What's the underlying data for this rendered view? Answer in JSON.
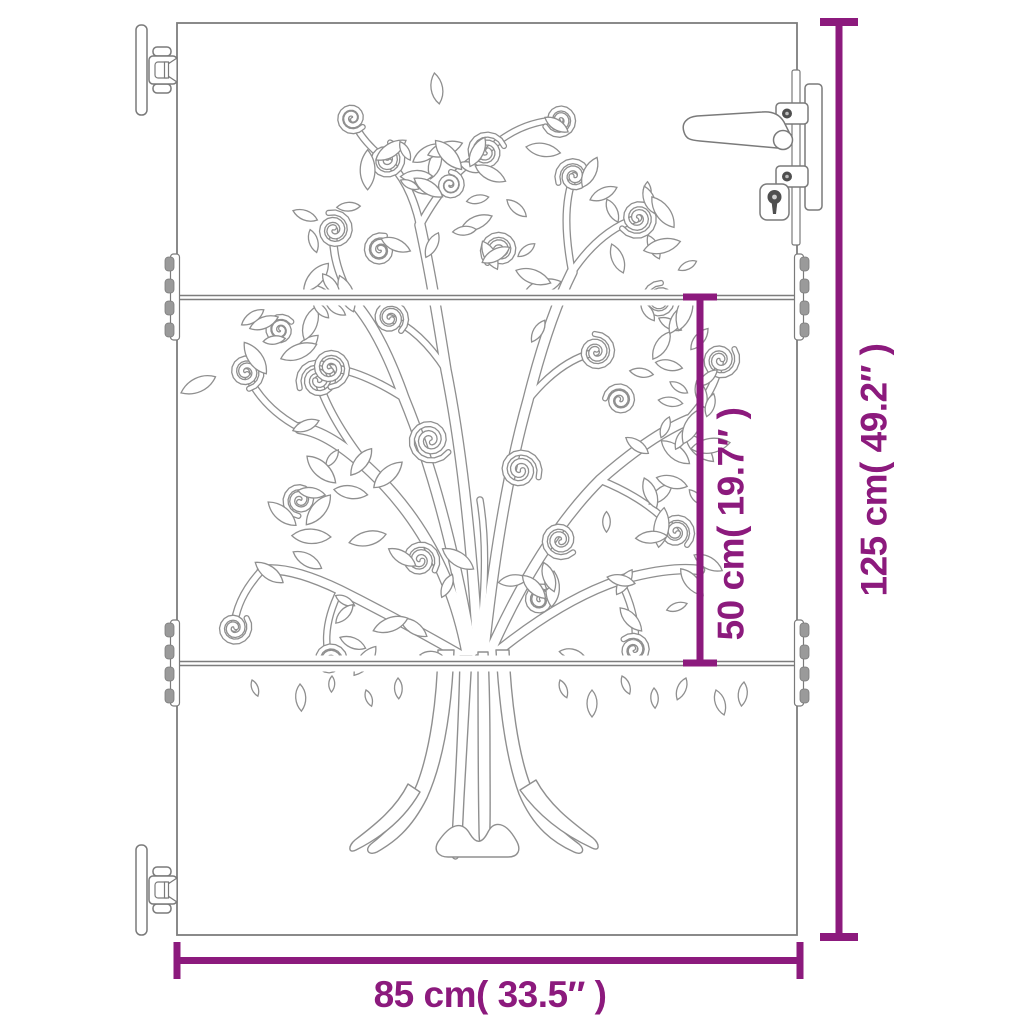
{
  "diagram": {
    "kind": "garden-gate-dimension-diagram",
    "dimensions": {
      "height_label": "125 cm( 49.2″ )",
      "width_label": "85 cm( 33.5″ )",
      "panel_label": "50 cm( 19.7″ )"
    },
    "colors": {
      "dimension_accent": "#8C1A7D",
      "frame_line": "#7d7d7d",
      "art_line": "#8f8f8f",
      "background": "#ffffff"
    }
  }
}
